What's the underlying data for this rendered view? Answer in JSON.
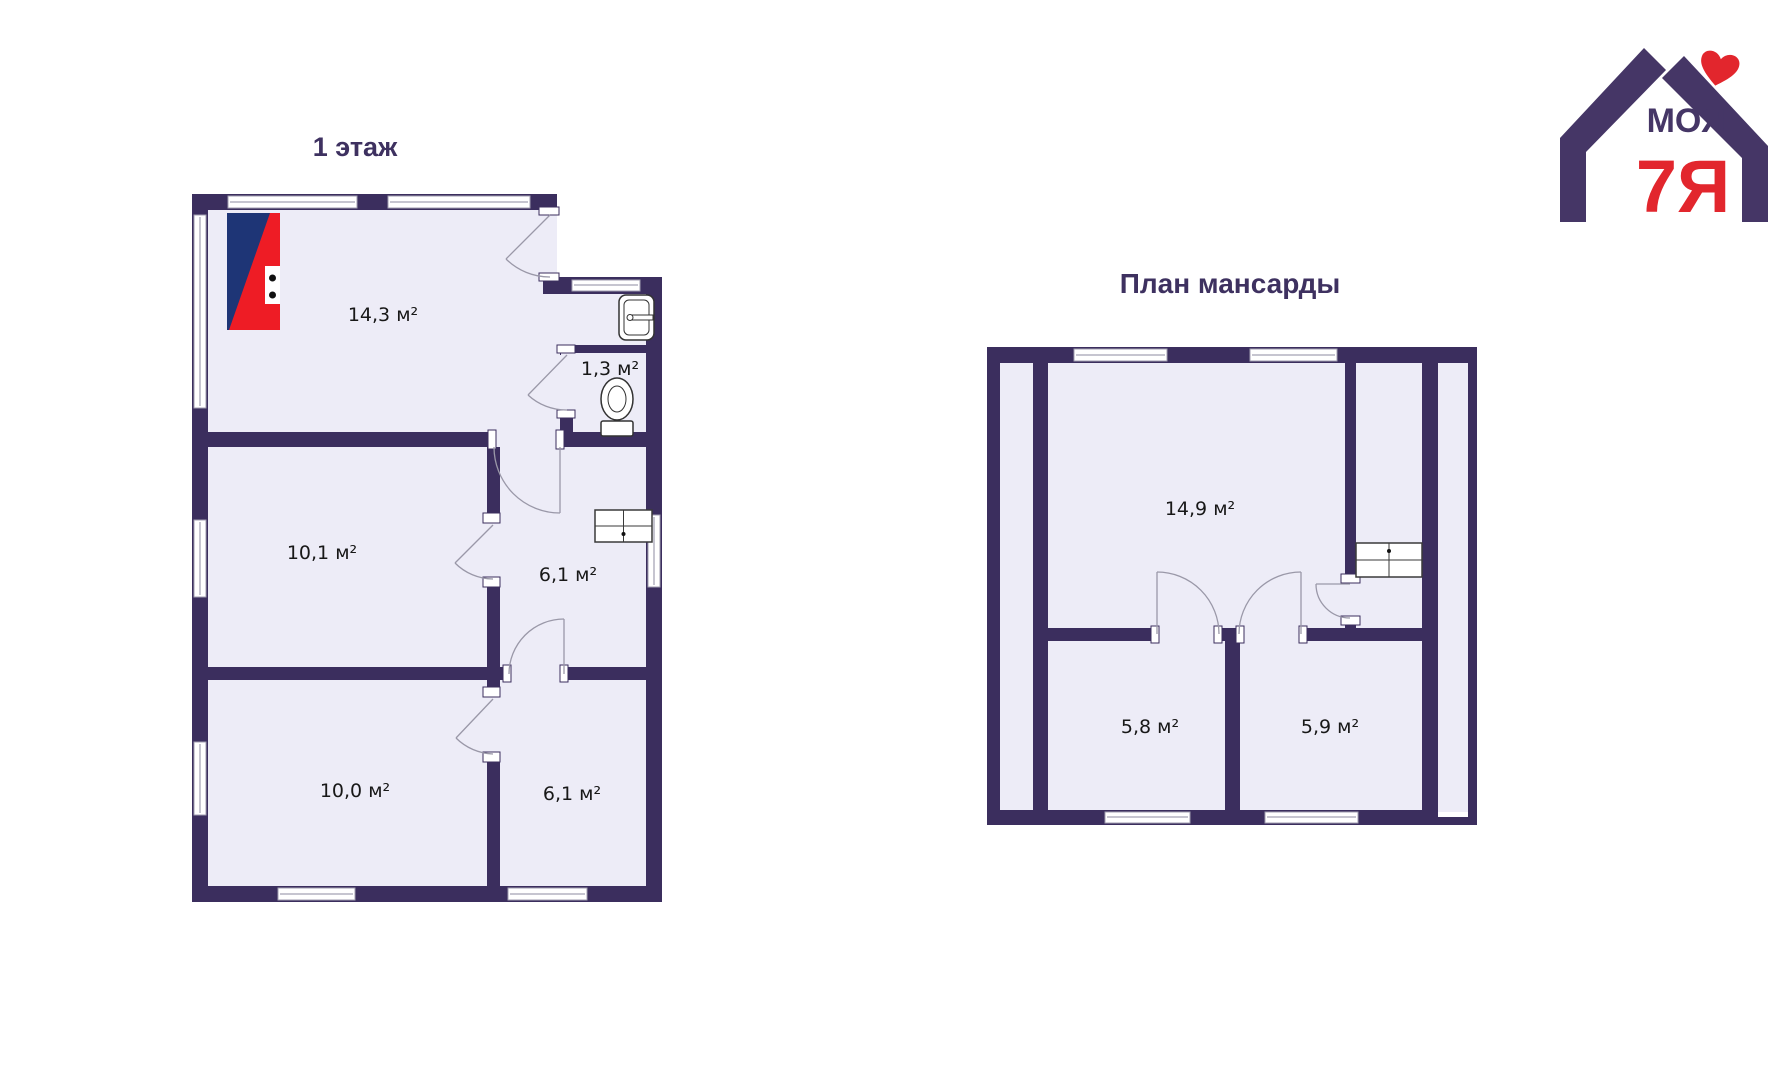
{
  "floor1": {
    "title": "1 этаж",
    "rooms": [
      {
        "id": "room-14-3",
        "area": "14,3 м²"
      },
      {
        "id": "room-1-3",
        "area": "1,3 м²"
      },
      {
        "id": "room-10-1",
        "area": "10,1 м²"
      },
      {
        "id": "room-6-1-middle",
        "area": "6,1 м²"
      },
      {
        "id": "room-10-0",
        "area": "10,0 м²"
      },
      {
        "id": "room-6-1-bottom",
        "area": "6,1 м²"
      }
    ]
  },
  "attic": {
    "title": "План мансарды",
    "rooms": [
      {
        "id": "room-14-9",
        "area": "14,9 м²"
      },
      {
        "id": "room-5-8",
        "area": "5,8 м²"
      },
      {
        "id": "room-5-9",
        "area": "5,9 м²"
      }
    ]
  },
  "logo": {
    "word_top": "МОЯ",
    "word_bottom": "7Я",
    "icon": "house-with-heart"
  },
  "icons": {
    "stove_flag": "diagonal blue/red stove symbol",
    "stove_flue": "stove-flue grid symbol",
    "toilet": "toilet symbol",
    "sink": "sink symbol"
  },
  "colors": {
    "wall": "#3b2e5e",
    "floor": "#edecf7",
    "title": "#3e3160",
    "label": "#181818",
    "logo_purple": "#453666",
    "logo_red": "#e2262d",
    "stove_blue": "#1e3576",
    "stove_red": "#ee1c25"
  }
}
